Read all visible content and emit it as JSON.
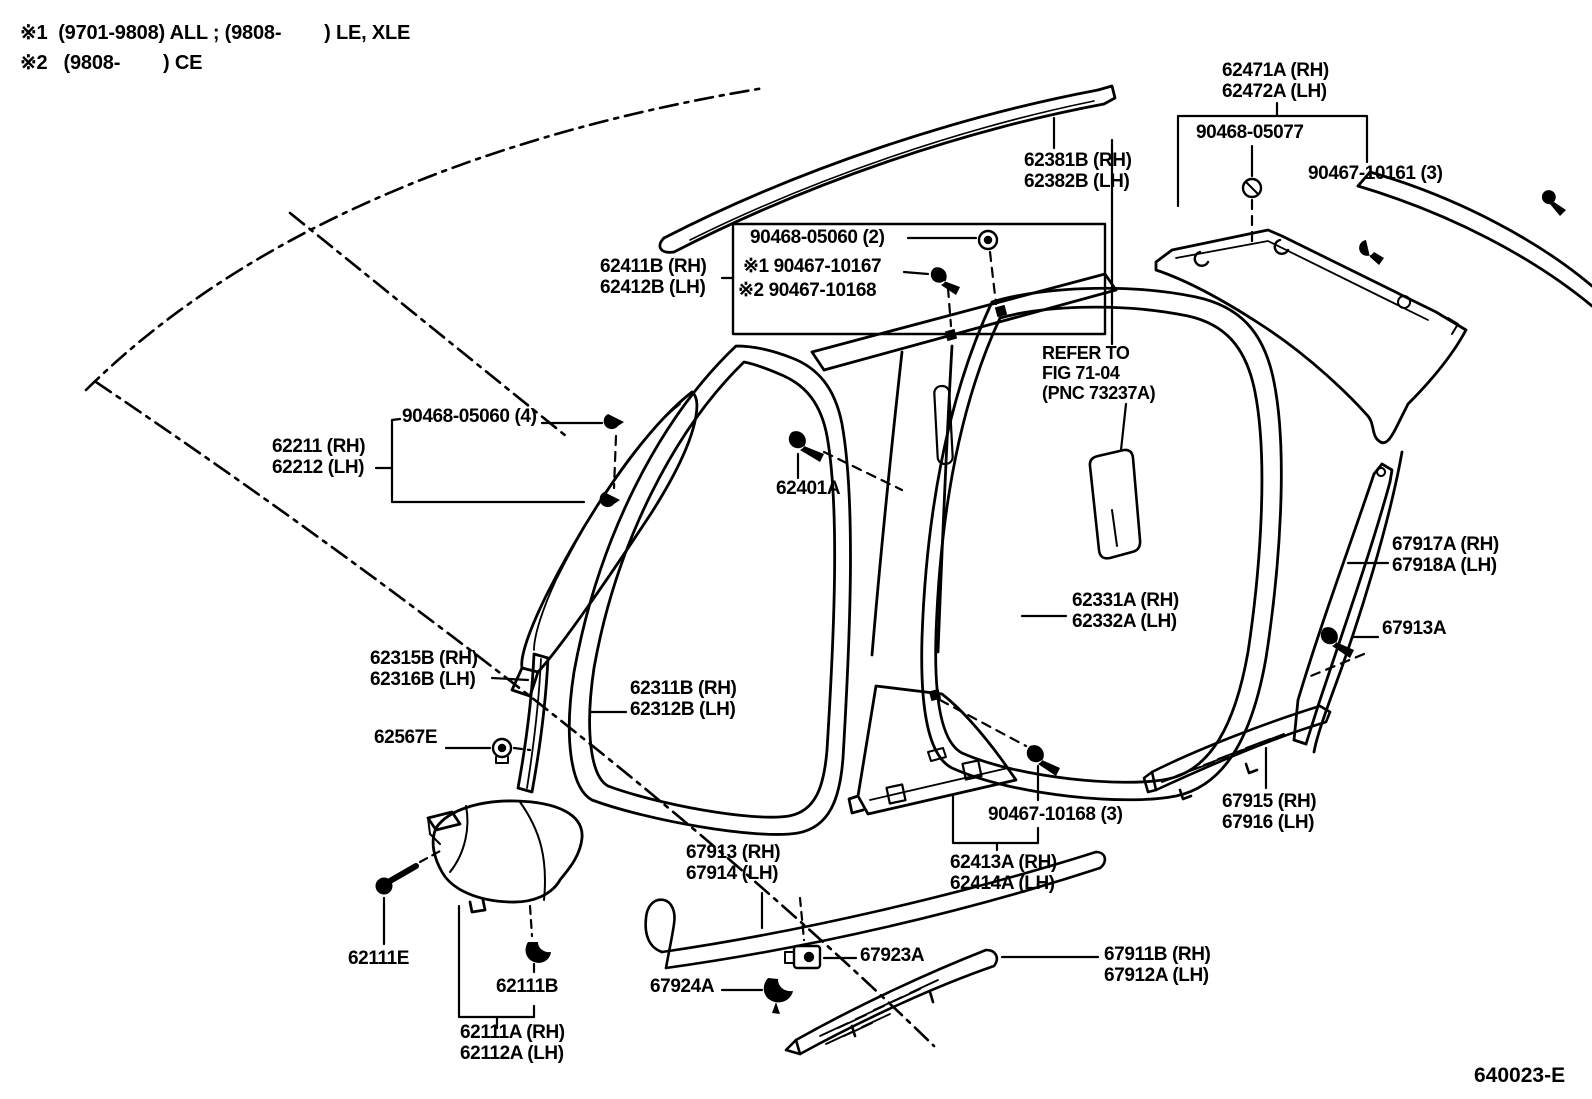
{
  "notes": {
    "note1": "※1  (9701-9808) ALL ; (9808-        ) LE, XLE",
    "note2": "※2   (9808-        ) CE"
  },
  "diagram_code": "640023-E",
  "colors": {
    "ink": "#000000",
    "paper": "#ffffff"
  },
  "icons": {
    "screw": "screw-icon",
    "grommet": "grommet-icon",
    "clip": "clip-icon",
    "bolt": "bolt-icon"
  },
  "labels": {
    "roof_side_garnish": [
      "62471A (RH)",
      "62472A (LH)"
    ],
    "grommet_05077": [
      "90468-05077"
    ],
    "screw_10161": [
      "90467-10161 (3)"
    ],
    "roof_drip_moulding": [
      "62381B (RH)",
      "62382B (LH)"
    ],
    "grommet_05060_2": [
      "90468-05060 (2)"
    ],
    "center_pillar_garnish_up": [
      "62411B (RH)",
      "62412B (LH)"
    ],
    "screw_10167": [
      "※1 90467-10167"
    ],
    "screw_10168_alt": [
      "※2 90467-10168"
    ],
    "refer_note": [
      "REFER TO",
      "FIG 71-04",
      "(PNC 73237A)"
    ],
    "grommet_05060_4": [
      "90468-05060 (4)"
    ],
    "front_pillar_garnish": [
      "62211 (RH)",
      "62212 (LH)"
    ],
    "clip_62401": [
      "62401A"
    ],
    "quarter_pillar_garnish": [
      "67917A (RH)",
      "67918A (LH)"
    ],
    "rear_door_opening_trim": [
      "62331A (RH)",
      "62332A (LH)"
    ],
    "screw_67913a": [
      "67913A"
    ],
    "windshield_side_garnish": [
      "62315B (RH)",
      "62316B (LH)"
    ],
    "front_door_opening_trim": [
      "62311B (RH)",
      "62312B (LH)"
    ],
    "clip_62567": [
      "62567E"
    ],
    "screw_10168_3": [
      "90467-10168 (3)"
    ],
    "rear_scuff_plate": [
      "67915 (RH)",
      "67916 (LH)"
    ],
    "front_door_scuff_plate": [
      "67913 (RH)",
      "67914 (LH)"
    ],
    "center_pillar_garnish_lo": [
      "62413A (RH)",
      "62414A (LH)"
    ],
    "bolt_62111e": [
      "62111E"
    ],
    "clip_67923": [
      "67923A"
    ],
    "clip_62111b": [
      "62111B"
    ],
    "clip_67924": [
      "67924A"
    ],
    "rear_door_scuff_plate": [
      "67911B (RH)",
      "67912A (LH)"
    ],
    "cowl_side_trim": [
      "62111A (RH)",
      "62112A (LH)"
    ]
  }
}
